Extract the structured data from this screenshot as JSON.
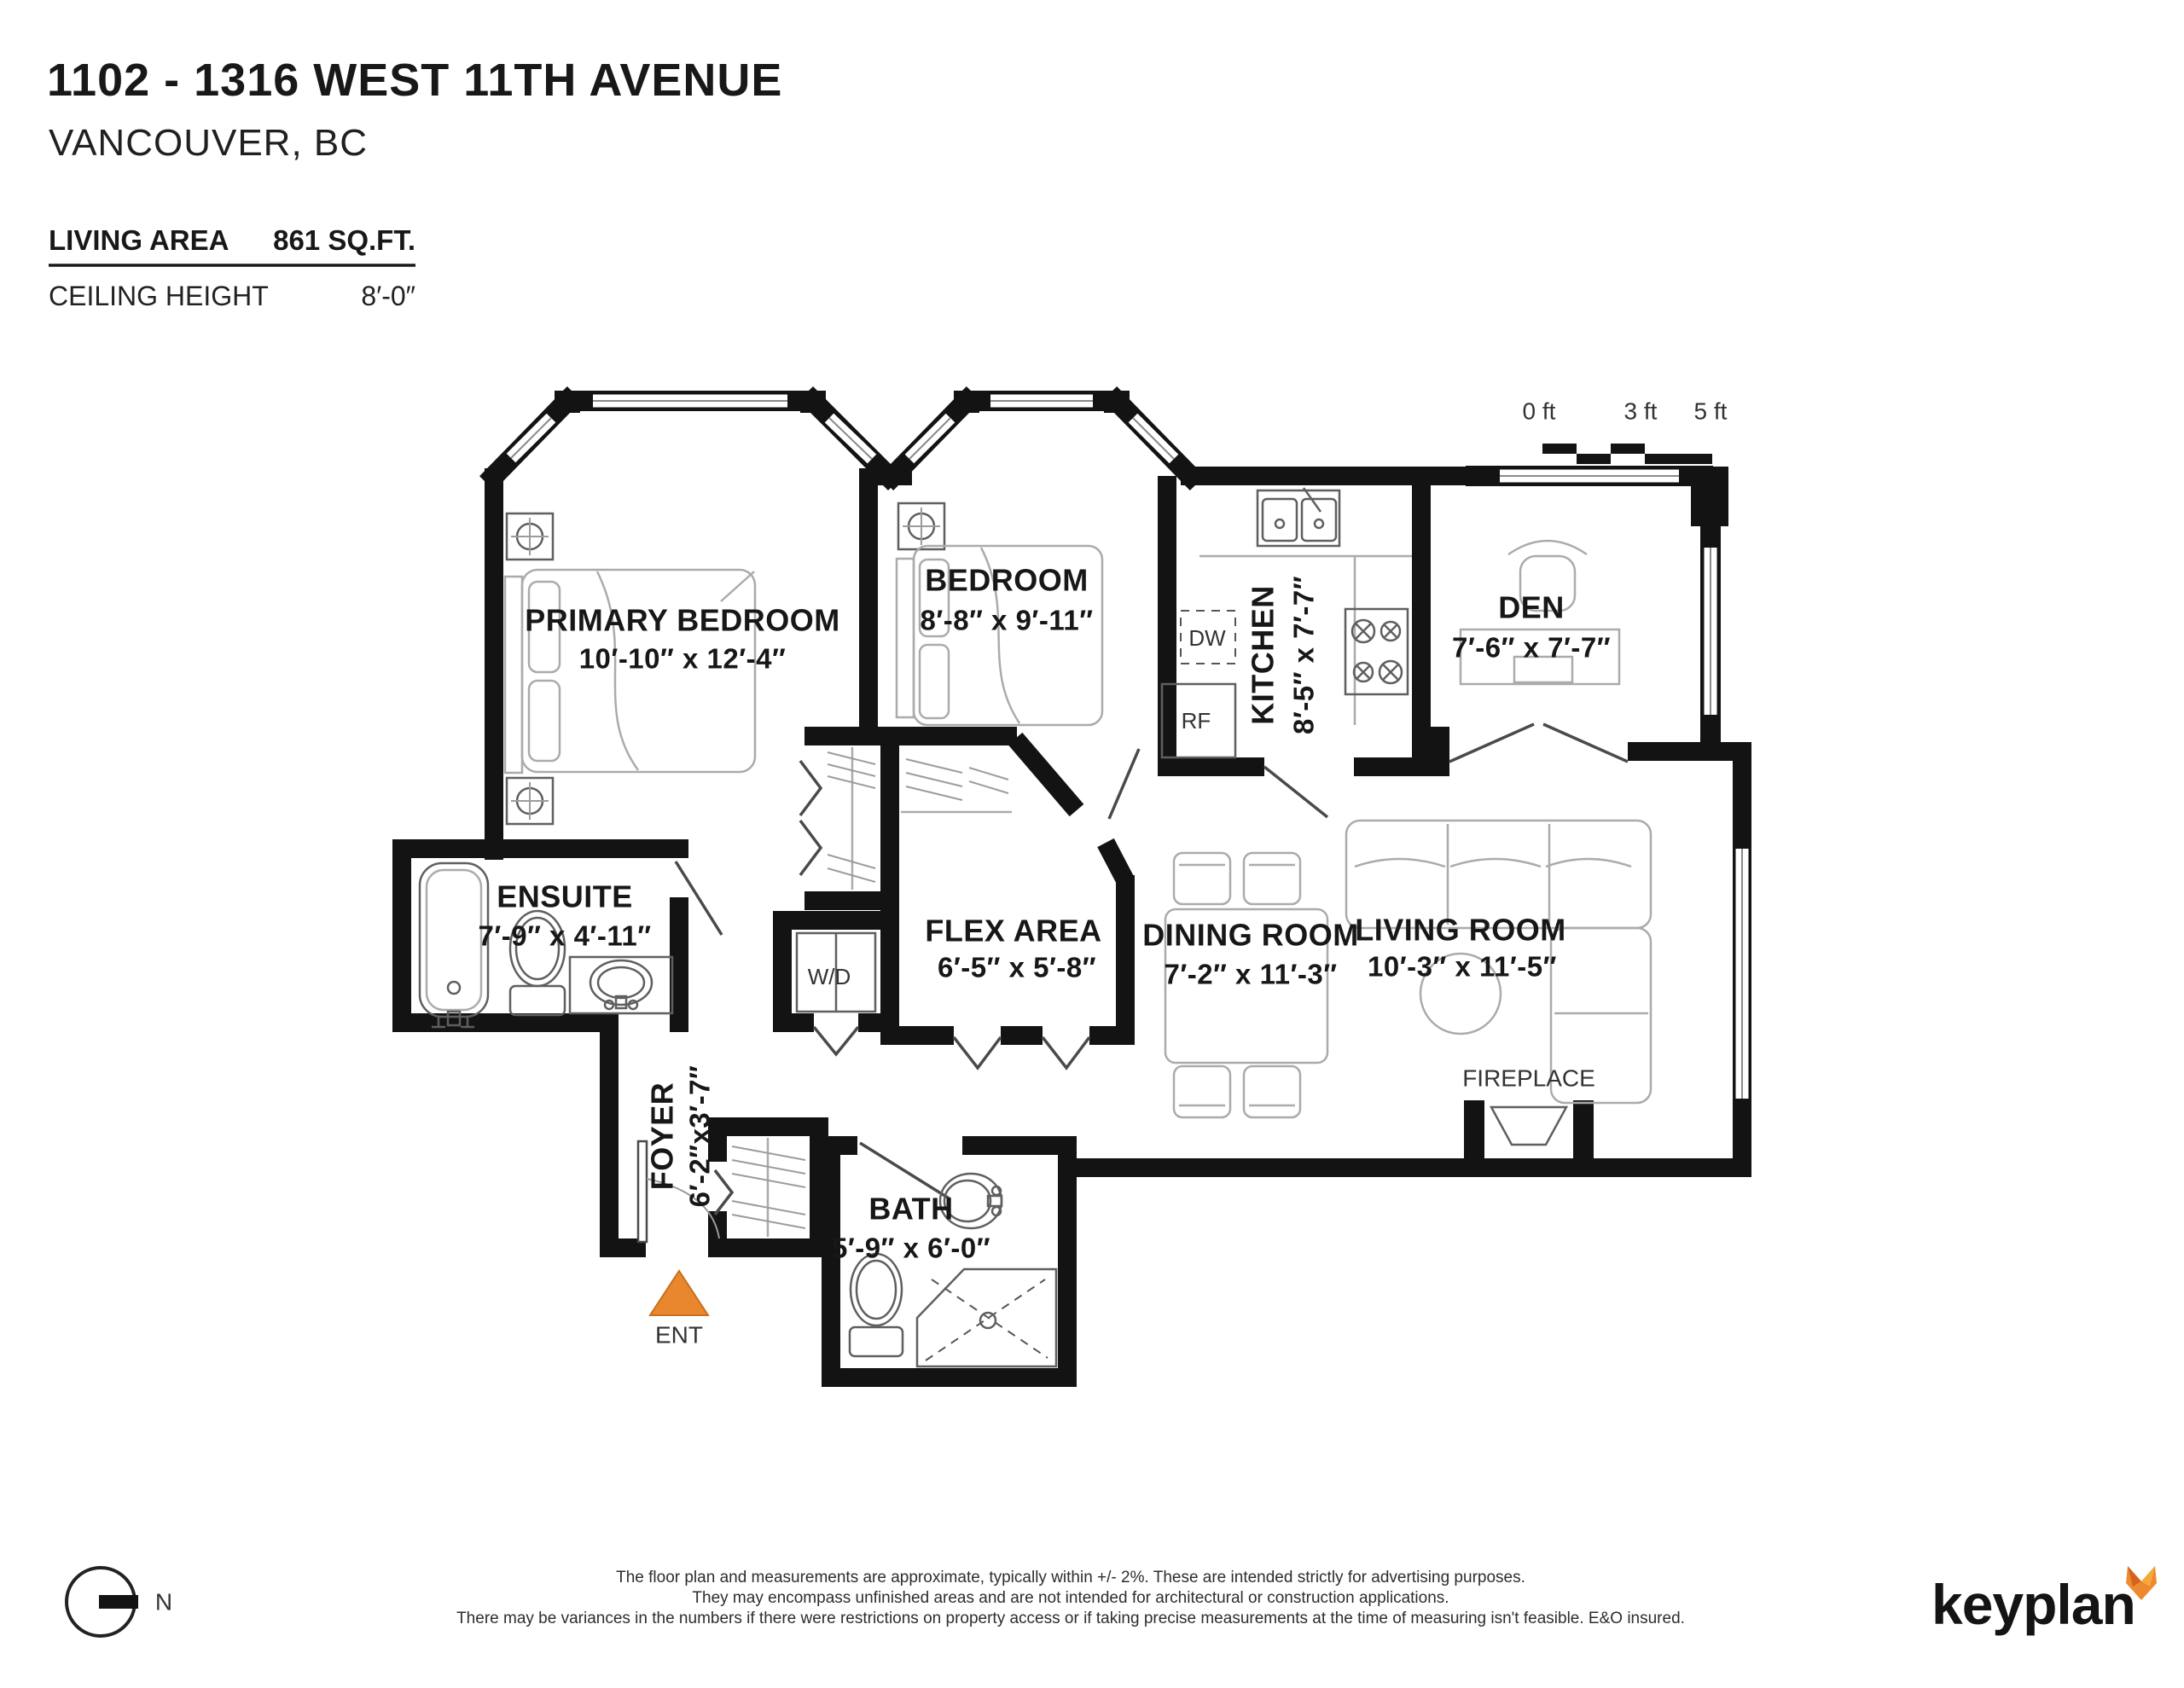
{
  "header": {
    "title": "1102 - 1316 WEST 11TH AVENUE",
    "city": "VANCOUVER, BC",
    "living_area_label": "LIVING AREA",
    "living_area_value": "861 SQ.FT.",
    "ceiling_height_label": "CEILING HEIGHT",
    "ceiling_height_value": "8′-0″"
  },
  "scale_bar": {
    "tick0": "0 ft",
    "tick3": "3 ft",
    "tick5": "5 ft"
  },
  "rooms": {
    "primary_bedroom": {
      "name": "PRIMARY BEDROOM",
      "dims": "10′-10″ x 12′-4″"
    },
    "bedroom": {
      "name": "BEDROOM",
      "dims": "8′-8″ x 9′-11″"
    },
    "kitchen": {
      "name": "KITCHEN",
      "dims": "8′-5″ x 7′-7″"
    },
    "den": {
      "name": "DEN",
      "dims": "7′-6″ x 7′-7″"
    },
    "ensuite": {
      "name": "ENSUITE",
      "dims": "7′-9″ x 4′-11″"
    },
    "flex_area": {
      "name": "FLEX AREA",
      "dims": "6′-5″ x 5′-8″"
    },
    "dining_room": {
      "name": "DINING ROOM",
      "dims": "7′-2″ x 11′-3″"
    },
    "living_room": {
      "name": "LIVING ROOM",
      "dims": "10′-3″ x 11′-5″"
    },
    "foyer": {
      "name": "FOYER",
      "dims": "6′-2″x3′-7″"
    },
    "bath": {
      "name": "BATH",
      "dims": "5′-9″ x 6′-0″"
    }
  },
  "annotations": {
    "fireplace": "FIREPLACE",
    "entry": "ENT",
    "washer_dryer": "W/D",
    "dishwasher": "DW",
    "refrigerator": "RF",
    "north": "N"
  },
  "footer": {
    "disclaimer_line1": "The floor plan and measurements are approximate, typically within +/- 2%. These are intended strictly for advertising purposes.",
    "disclaimer_line2": "They may encompass unfinished areas and are not intended for architectural or construction applications.",
    "disclaimer_line3": "There may be variances in the numbers if there were restrictions on property access or if taking precise measurements at the time of measuring isn't feasible. E&O insured.",
    "brand": "keyplan"
  },
  "colors": {
    "wall": "#131313",
    "entry_marker": "#E8872E",
    "brand_fox": "#ED8A2F"
  }
}
